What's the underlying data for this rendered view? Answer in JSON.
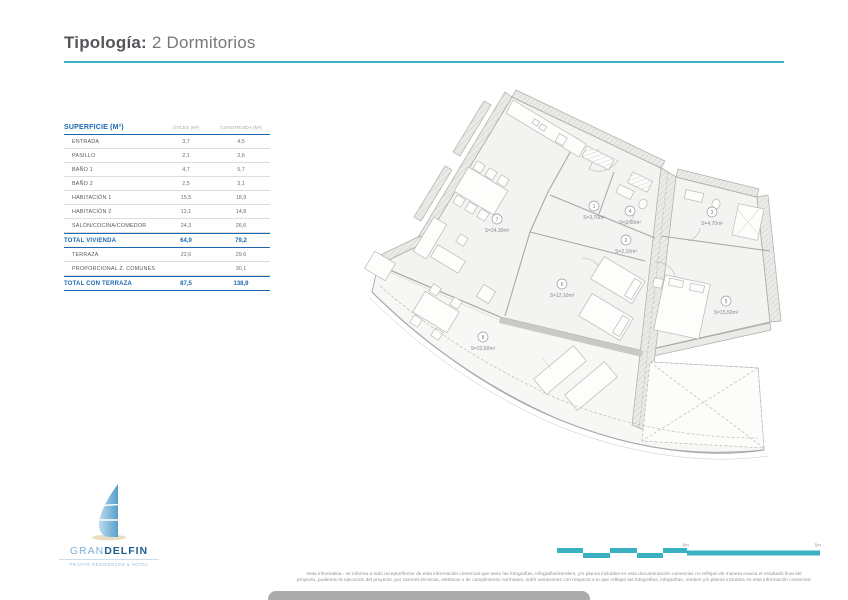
{
  "page": {
    "title_label": "Tipología:",
    "title_value": "2 Dormitorios"
  },
  "table": {
    "title": "SUPERFICIE (M²)",
    "col_utiles": "ÚTILES (M²)",
    "col_construida": "CONSTRUIDA (M²)",
    "rows": [
      {
        "label": "ENTRADA",
        "utiles": "3,7",
        "construida": "4,5",
        "type": "normal"
      },
      {
        "label": "PASILLO",
        "utiles": "2,1",
        "construida": "2,6",
        "type": "normal"
      },
      {
        "label": "BAÑO 1",
        "utiles": "4,7",
        "construida": "5,7",
        "type": "normal"
      },
      {
        "label": "BAÑO 2",
        "utiles": "2,5",
        "construida": "3,1",
        "type": "normal"
      },
      {
        "label": "HABITACIÓN 1",
        "utiles": "15,5",
        "construida": "18,9",
        "type": "normal"
      },
      {
        "label": "HABITACIÓN 2",
        "utiles": "12,1",
        "construida": "14,8",
        "type": "normal"
      },
      {
        "label": "SALÓN/COCINA/COMEDOR",
        "utiles": "24,3",
        "construida": "26,6",
        "type": "normal"
      },
      {
        "label": "TOTAL VIVIENDA",
        "utiles": "64,9",
        "construida": "79,2",
        "type": "total"
      },
      {
        "label": "TERRAZA",
        "utiles": "22,6",
        "construida": "29,6",
        "type": "normal"
      },
      {
        "label": "PROPORCIONAL Z. COMUNES",
        "utiles": "",
        "construida": "30,1",
        "type": "normal"
      },
      {
        "label": "TOTAL CON TERRAZA",
        "utiles": "87,5",
        "construida": "138,9",
        "type": "total"
      }
    ]
  },
  "plan": {
    "rooms": [
      {
        "num": "1",
        "area": "S=3,70m²",
        "x": 594,
        "y": 206
      },
      {
        "num": "4",
        "area": "S=2,50m²",
        "x": 630,
        "y": 211
      },
      {
        "num": "3",
        "area": "S=4,70m²",
        "x": 712,
        "y": 212
      },
      {
        "num": "2",
        "area": "S=2,10m²",
        "x": 626,
        "y": 240
      },
      {
        "num": "6",
        "area": "S=12,10m²",
        "x": 562,
        "y": 284
      },
      {
        "num": "5",
        "area": "S=15,50m²",
        "x": 726,
        "y": 301
      },
      {
        "num": "7",
        "area": "S=24,30m²",
        "x": 497,
        "y": 219
      },
      {
        "num": "8",
        "area": "S=22,60m²",
        "x": 483,
        "y": 337
      }
    ]
  },
  "logo": {
    "brand_light": "GRAN",
    "brand_bold": "DELFIN",
    "subtitle": "PRIVATE RESIDENCES & HOTEL"
  },
  "scalebar": {
    "zero_label": "0m",
    "end_label": "5m"
  },
  "footnote": {
    "line1": "Nota informativa.- se informa a todo receptor/lector de esta información comercial que tanto las fotografías, infografías/renders, y/o planos incluidos en esta documentación comercial, no reflejan de manera exacta el resultado final del",
    "line2": "proyecto, pudiendo la ejecución del proyecto, por razones técnicas, estéticas o de cumplimiento normativa, sufrir variaciones con respecto a lo que reflejan las fotografías, infografías, renders y/o planos incluidos en esta información comercial."
  },
  "colors": {
    "accent_teal": "#3ab1c2",
    "table_blue": "#1a69b0",
    "logo_dark": "#1d5e8c",
    "logo_light": "#7cb1d8"
  }
}
